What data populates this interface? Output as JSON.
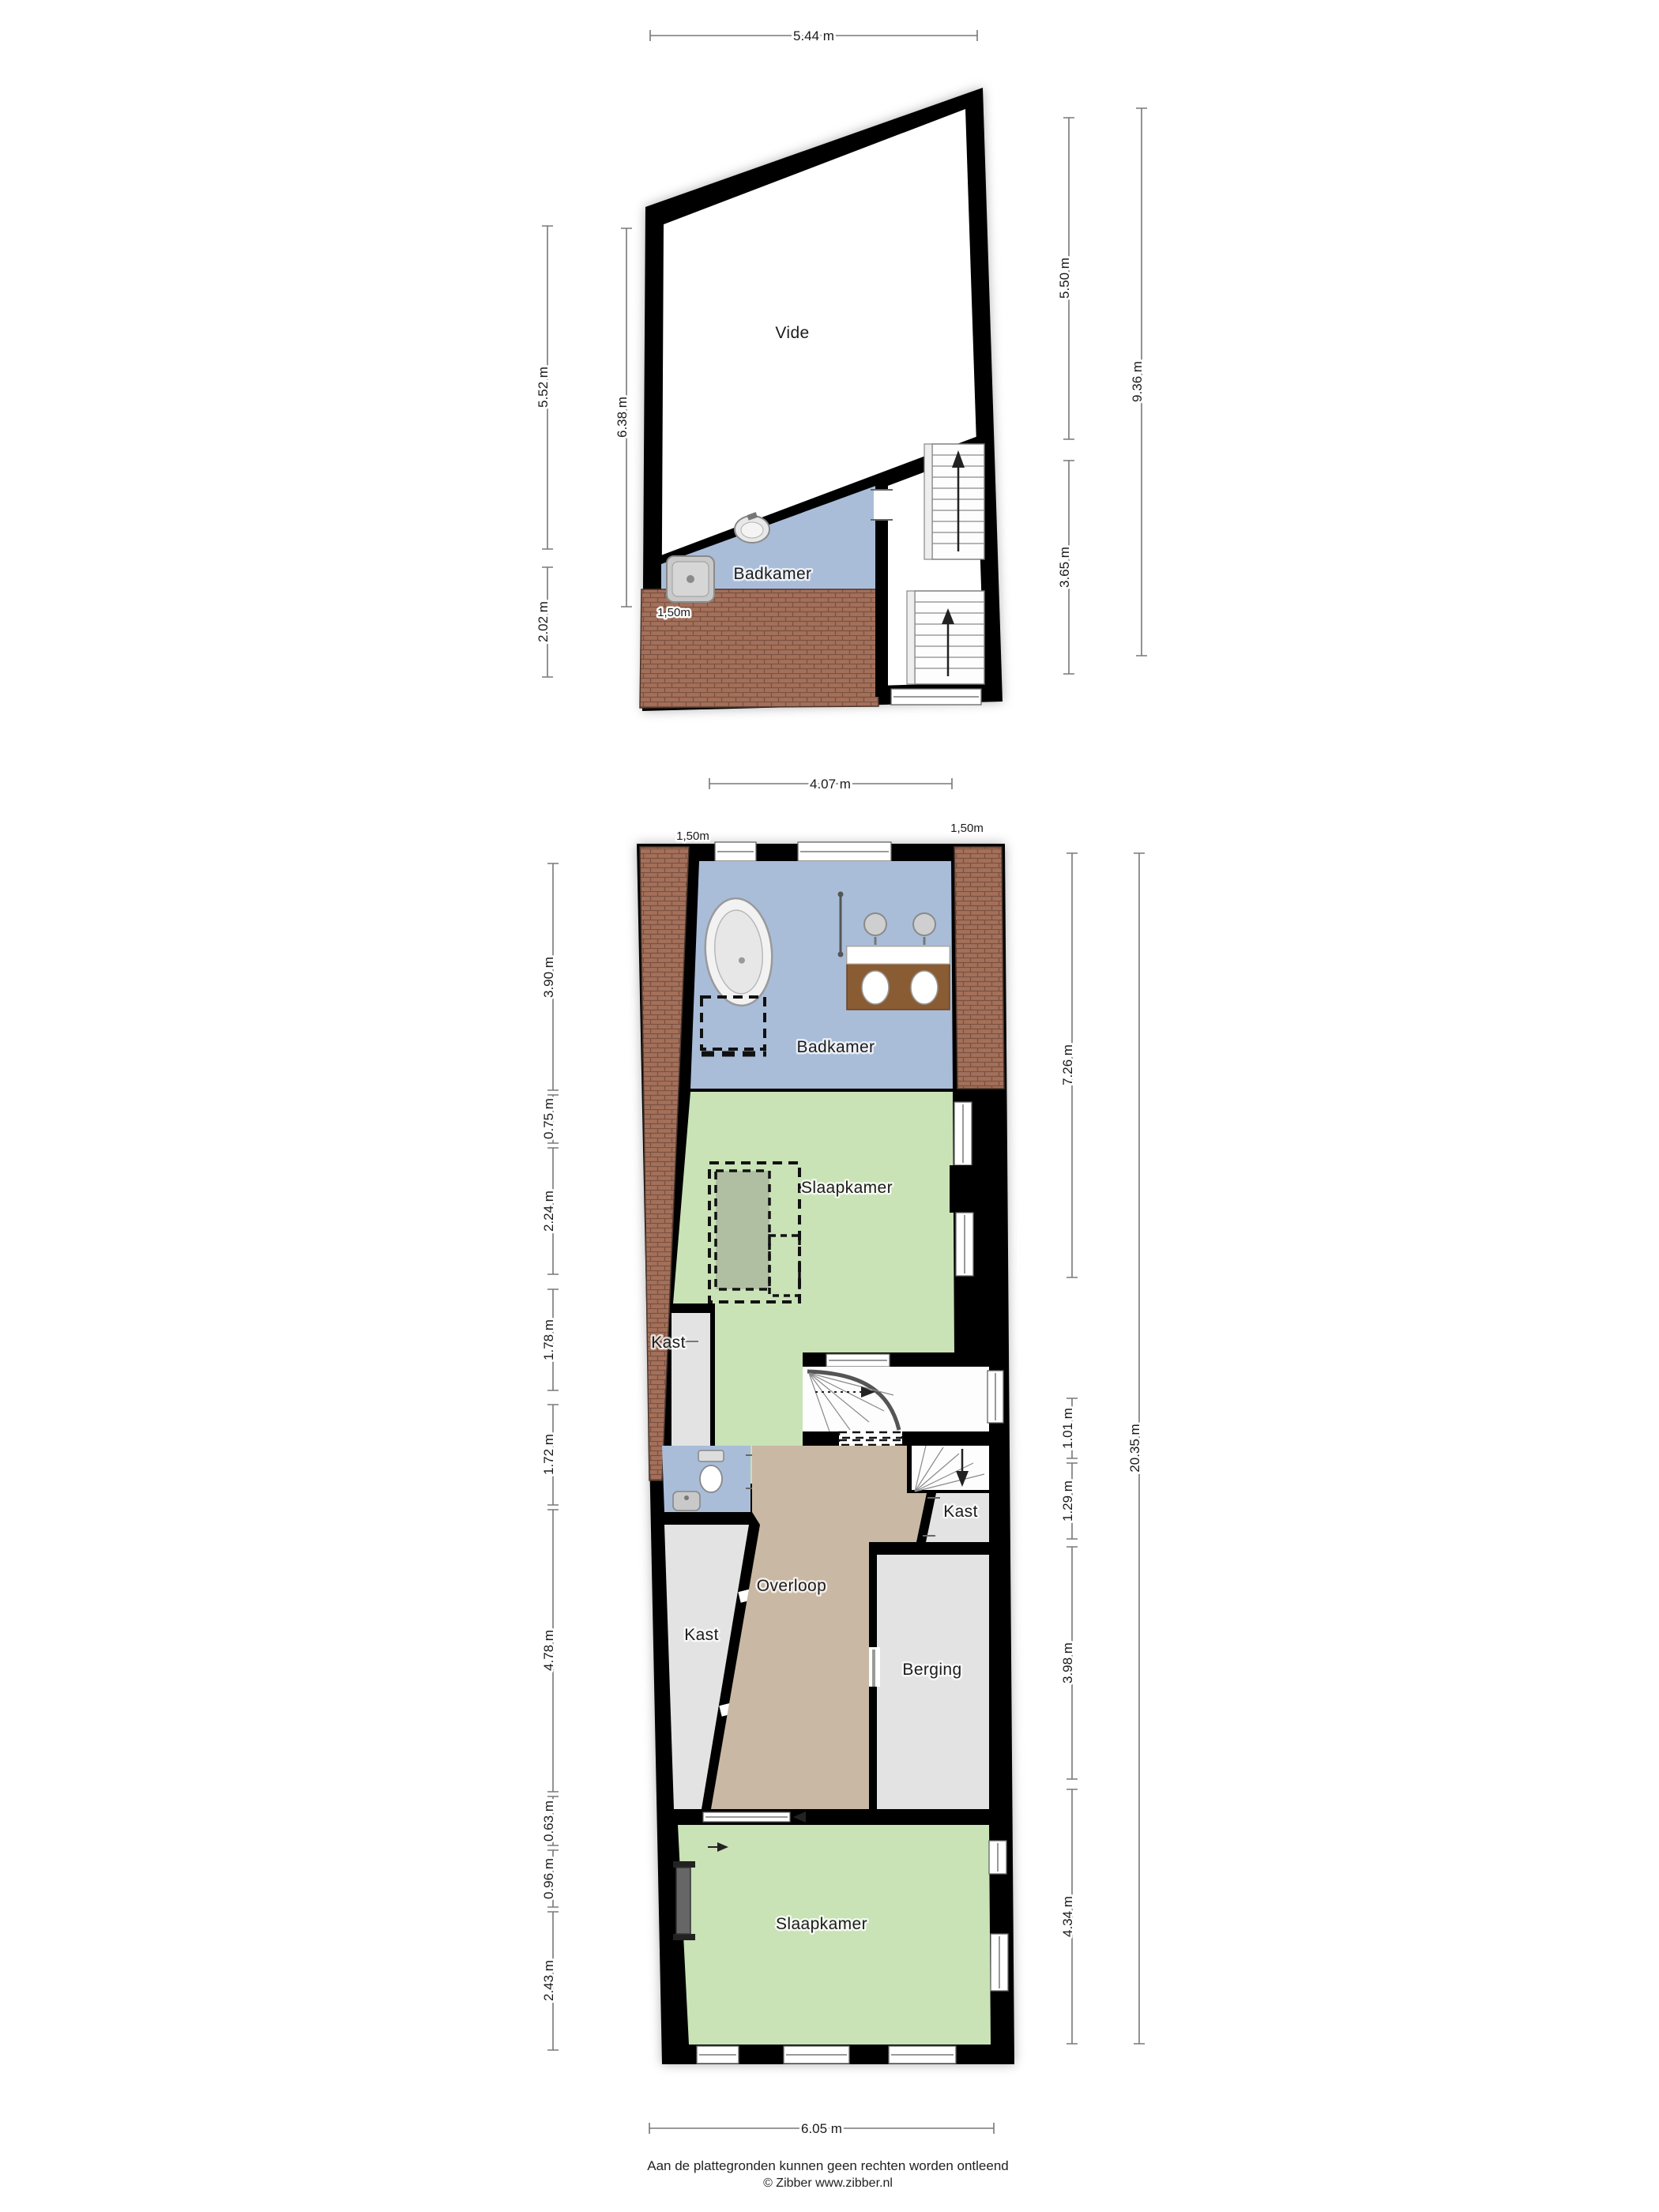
{
  "colors": {
    "wall_black": "#000000",
    "bathroom_blue": "#a9bdd9",
    "bedroom_green": "#c9e2b6",
    "hall_tan": "#c9b8a3",
    "closet_gray": "#e3e3e3",
    "roof_brown": "#a4705a",
    "dim_gray": "#787878"
  },
  "plan_top": {
    "rooms": {
      "vide": "Vide",
      "badkamer": "Badkamer"
    },
    "dims": {
      "width_top": "5.44 m",
      "left_main": "5.52 m",
      "left_inner": "6.38 m",
      "left_lower": "2.02 m",
      "right_upper": "5.50 m",
      "right_lower": "3.65 m",
      "right_total": "9.36 m",
      "headroom": "1,50m"
    }
  },
  "plan_bottom": {
    "rooms": {
      "badkamer": "Badkamer",
      "slaapkamer_1": "Slaapkamer",
      "kast_upper_left": "Kast",
      "kast_lower_left": "Kast",
      "kast_right": "Kast",
      "overloop": "Overloop",
      "berging": "Berging",
      "slaapkamer_2": "Slaapkamer"
    },
    "dims": {
      "width_top": "4.07 m",
      "headroom_left": "1,50m",
      "headroom_right": "1,50m",
      "left_1": "3.90 m",
      "left_2": "0.75 m",
      "left_3": "2.24 m",
      "left_4": "1.78 m",
      "left_5": "1.72 m",
      "left_6": "4.78 m",
      "left_7": "0.63 m",
      "left_8": "0.96 m",
      "left_9": "2.43 m",
      "right_1": "7.26 m",
      "right_2": "1.01 m",
      "right_3": "1.29 m",
      "right_4": "3.98 m",
      "right_5": "4.34 m",
      "right_total": "20.35 m",
      "width_bottom": "6.05 m"
    }
  },
  "footer": {
    "disclaimer": "Aan de plattegronden kunnen geen rechten worden ontleend",
    "credit": "© Zibber www.zibber.nl"
  }
}
